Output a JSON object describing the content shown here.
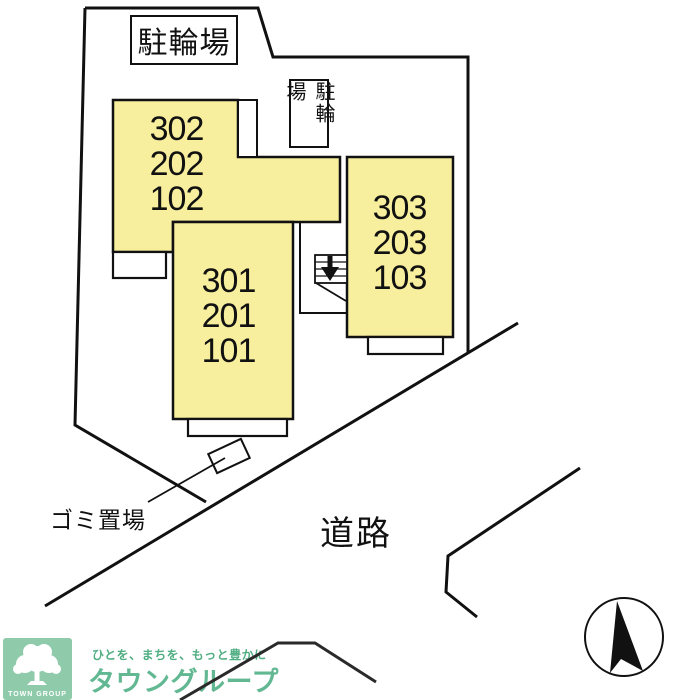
{
  "page": {
    "width": 700,
    "height": 700,
    "background": "#ffffff"
  },
  "colors": {
    "building_fill": "#F7EE9E",
    "line": "#111111",
    "logo_bg_green": "#8FCBAB",
    "logo_brand_green": "#62B892",
    "logo_tagline_green": "#4FAE82"
  },
  "labels": {
    "bicycle_parking_top": "駐輪場",
    "bicycle_parking_side": "駐輪場",
    "garbage_area": "ゴミ置場",
    "road": "道路"
  },
  "buildings": [
    {
      "id": "west-block",
      "units": [
        "302",
        "202",
        "102"
      ]
    },
    {
      "id": "south-block",
      "units": [
        "301",
        "201",
        "101"
      ]
    },
    {
      "id": "east-block",
      "units": [
        "303",
        "203",
        "103"
      ]
    }
  ],
  "logo": {
    "group_name_en": "TOWN GROUP",
    "tagline": "ひとを、まちを、もっと豊かに",
    "brand": "タウングループ"
  }
}
